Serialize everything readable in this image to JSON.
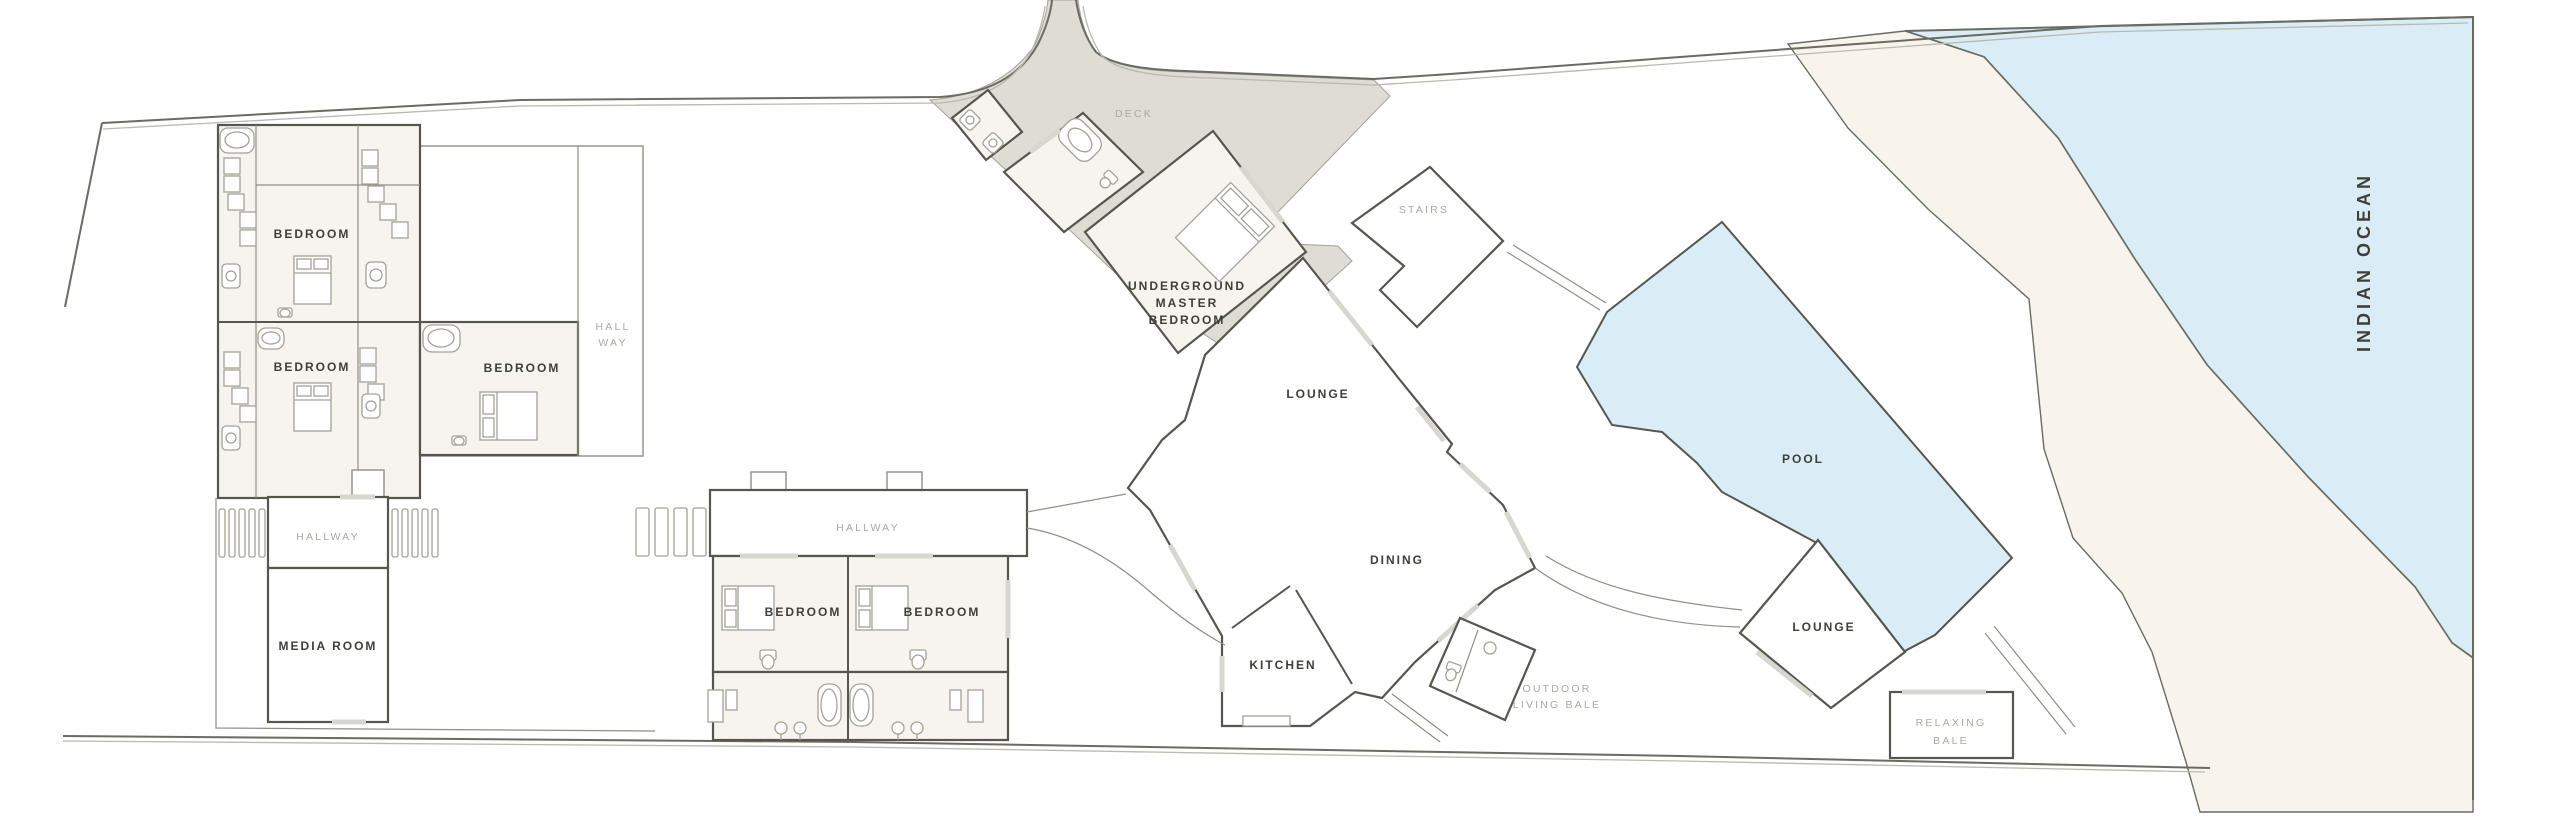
{
  "labels": {
    "bedroom": "BEDROOM",
    "hall_line1": "HALL",
    "hall_line2": "WAY",
    "hallway": "HALLWAY",
    "media_room": "MEDIA ROOM",
    "deck": "DECK",
    "underground_line1": "UNDERGROUND",
    "underground_line2": "MASTER",
    "underground_line3": "BEDROOM",
    "stairs": "STAIRS",
    "lounge": "LOUNGE",
    "dining": "DINING",
    "kitchen": "KITCHEN",
    "outdoor_bale_line1": "OUTDOOR",
    "outdoor_bale_line2": "LIVING BALE",
    "pool": "POOL",
    "pool_lounge": "LOUNGE",
    "relaxing_line1": "RELAXING",
    "relaxing_line2": "BALE",
    "indian_ocean": "INDIAN OCEAN"
  },
  "colors": {
    "boundary": "#6a6b61",
    "boundary_light": "#b9b9ae",
    "wall": "#55564e",
    "wall_light": "#8e8f85",
    "fixture": "#a3a296",
    "door": "#d8d7cf",
    "room": "#f7f3ee",
    "deck": "#dfdbd5",
    "water": "#daedf7",
    "sand": "#f9f3ee",
    "label_dark": "#3d3f38",
    "label_grey": "#aaa9a0"
  }
}
